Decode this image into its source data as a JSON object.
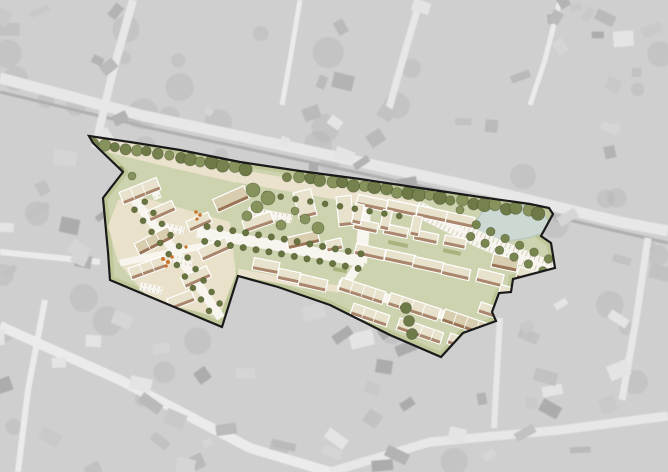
{
  "canvas": {
    "w": 668,
    "h": 472
  },
  "colors": {
    "aerial_base": "#b9b9b9",
    "aerial_road": "#dcdcdc",
    "aerial_road_light": "#e2e2e2",
    "aerial_veg": "#8a8a8a",
    "overlay_white": "#ffffff",
    "site_green": "#cdd3ae",
    "verge": "#b9c392",
    "plaza": "#e9e1ca",
    "street_beige": "#eae2cc",
    "street_white": "#f7f5ee",
    "tick": "#c6bfa9",
    "building": "#e8e2cc",
    "building_dark": "#d9cdaf",
    "band": "#a9866c",
    "band_dark": "#997455",
    "building_outline": "#ffffff",
    "boundary": "#1a1a1a",
    "pond_fill": "#ccd9d3",
    "pond_edge": "#b7c7bf",
    "hedge": "#a9b37e",
    "tree_palette": [
      "#76824d",
      "#87935c",
      "#6d7a47"
    ],
    "street_tree": "#68743f",
    "avenue_tree": "#79854f",
    "column_tree": "#6e7a48",
    "orange": "#c8742e",
    "house_shades": [
      "#8f8f8f",
      "#9a9a9a",
      "#a5a5a5",
      "#b0b0b0",
      "#858585",
      "#c2c2c2",
      "#d8d8d8"
    ]
  },
  "aerial": {
    "seed_houses": 7,
    "seed_veg": 23,
    "house_count": 130,
    "veg_count": 52,
    "overlay_opacity": 0.32,
    "roads": [
      {
        "pts": [
          [
            0,
            78
          ],
          [
            140,
            115
          ],
          [
            300,
            149
          ],
          [
            470,
            186
          ],
          [
            620,
            222
          ],
          [
            668,
            231
          ]
        ],
        "w": 11,
        "c": "aerial_road"
      },
      {
        "pts": [
          [
            0,
            92
          ],
          [
            150,
            128
          ],
          [
            300,
            160
          ],
          [
            470,
            197
          ],
          [
            668,
            243
          ]
        ],
        "w": 3,
        "c": "aerial_veg"
      },
      {
        "pts": [
          [
            133,
            0
          ],
          [
            112,
            75
          ],
          [
            95,
            148
          ]
        ],
        "w": 8,
        "c": "aerial_road"
      },
      {
        "pts": [
          [
            300,
            0
          ],
          [
            290,
            60
          ],
          [
            282,
            105
          ]
        ],
        "w": 5,
        "c": "aerial_road_light"
      },
      {
        "pts": [
          [
            420,
            0
          ],
          [
            402,
            62
          ],
          [
            388,
            112
          ]
        ],
        "w": 7,
        "c": "aerial_road"
      },
      {
        "pts": [
          [
            560,
            0
          ],
          [
            545,
            60
          ],
          [
            530,
            105
          ]
        ],
        "w": 5,
        "c": "aerial_road_light"
      },
      {
        "pts": [
          [
            0,
            326
          ],
          [
            120,
            380
          ],
          [
            250,
            448
          ],
          [
            330,
            472
          ]
        ],
        "w": 10,
        "c": "aerial_road_light"
      },
      {
        "pts": [
          [
            330,
            472
          ],
          [
            430,
            442
          ],
          [
            560,
            430
          ],
          [
            668,
            416
          ]
        ],
        "w": 9,
        "c": "aerial_road"
      },
      {
        "pts": [
          [
            500,
            318
          ],
          [
            497,
            372
          ],
          [
            494,
            428
          ]
        ],
        "w": 6,
        "c": "aerial_road"
      },
      {
        "pts": [
          [
            648,
            238
          ],
          [
            636,
            320
          ],
          [
            622,
            400
          ]
        ],
        "w": 7,
        "c": "aerial_road"
      },
      {
        "pts": [
          [
            45,
            300
          ],
          [
            28,
            390
          ],
          [
            18,
            472
          ]
        ],
        "w": 6,
        "c": "aerial_road_light"
      },
      {
        "pts": [
          [
            0,
            252
          ],
          [
            60,
            258
          ],
          [
            100,
            262
          ]
        ],
        "w": 6,
        "c": "aerial_road_light"
      }
    ]
  },
  "site": {
    "boundary": [
      [
        89,
        136
      ],
      [
        130,
        142
      ],
      [
        180,
        150
      ],
      [
        240,
        162
      ],
      [
        300,
        171
      ],
      [
        360,
        179
      ],
      [
        420,
        188
      ],
      [
        480,
        197
      ],
      [
        530,
        204
      ],
      [
        549,
        208
      ],
      [
        553,
        214
      ],
      [
        541,
        236
      ],
      [
        551,
        243
      ],
      [
        555,
        268
      ],
      [
        513,
        279
      ],
      [
        511,
        292
      ],
      [
        499,
        293
      ],
      [
        492,
        312
      ],
      [
        496,
        321
      ],
      [
        463,
        333
      ],
      [
        441,
        357
      ],
      [
        390,
        335
      ],
      [
        330,
        305
      ],
      [
        278,
        287
      ],
      [
        238,
        276
      ],
      [
        222,
        327
      ],
      [
        110,
        280
      ],
      [
        108,
        252
      ],
      [
        103,
        198
      ],
      [
        123,
        172
      ],
      [
        93,
        143
      ]
    ],
    "top_edge_count": 10,
    "plaza": [
      [
        138,
        196
      ],
      [
        230,
        222
      ],
      [
        236,
        274
      ],
      [
        219,
        317
      ],
      [
        150,
        300
      ],
      [
        118,
        262
      ],
      [
        108,
        226
      ],
      [
        118,
        200
      ]
    ],
    "pond": [
      [
        476,
        222
      ],
      [
        482,
        212
      ],
      [
        496,
        206
      ],
      [
        514,
        204
      ],
      [
        532,
        207
      ],
      [
        545,
        214
      ],
      [
        549,
        224
      ],
      [
        543,
        233
      ],
      [
        528,
        238
      ],
      [
        508,
        241
      ],
      [
        490,
        238
      ],
      [
        479,
        232
      ]
    ],
    "streets": [
      {
        "pts": [
          [
            92,
            141
          ],
          [
            160,
            158
          ],
          [
            238,
            176
          ]
        ],
        "w": 14,
        "c": "street_beige",
        "ticks": false
      },
      {
        "pts": [
          [
            238,
            176
          ],
          [
            330,
            192
          ],
          [
            418,
            208
          ]
        ],
        "w": 13,
        "c": "street_beige",
        "ticks": false
      },
      {
        "pts": [
          [
            238,
            272
          ],
          [
            300,
            284
          ],
          [
            340,
            289
          ]
        ],
        "w": 7,
        "c": "street_beige",
        "ticks": false
      },
      {
        "pts": [
          [
            416,
            208
          ],
          [
            480,
            240
          ],
          [
            553,
            270
          ]
        ],
        "w": 16,
        "c": "street_white",
        "ticks": true
      },
      {
        "pts": [
          [
            366,
            197
          ],
          [
            361,
            263
          ]
        ],
        "w": 12,
        "c": "street_white",
        "ticks": false
      },
      {
        "pts": [
          [
            361,
            262
          ],
          [
            344,
            286
          ]
        ],
        "w": 9,
        "c": "street_white",
        "ticks": false
      },
      {
        "pts": [
          [
            197,
            232
          ],
          [
            280,
            246
          ],
          [
            364,
            262
          ]
        ],
        "w": 11,
        "c": "street_white",
        "ticks": false
      },
      {
        "pts": [
          [
            338,
            284
          ],
          [
            420,
            308
          ],
          [
            491,
            329
          ]
        ],
        "w": 10,
        "c": "street_white",
        "ticks": false
      },
      {
        "pts": [
          [
            133,
            198
          ],
          [
            180,
            258
          ],
          [
            221,
            318
          ]
        ],
        "w": 9,
        "c": "street_white",
        "ticks": false
      },
      {
        "pts": [
          [
            120,
            263
          ],
          [
            232,
            240
          ]
        ],
        "w": 7,
        "c": "street_white",
        "ticks": false
      }
    ],
    "parking_strips": [
      {
        "pts": [
          [
            248,
            211
          ],
          [
            292,
            219
          ]
        ],
        "w": 9
      },
      {
        "pts": [
          [
            162,
            226
          ],
          [
            184,
            231
          ]
        ],
        "w": 8
      },
      {
        "pts": [
          [
            170,
            258
          ],
          [
            192,
            263
          ]
        ],
        "w": 8
      },
      {
        "pts": [
          [
            140,
            286
          ],
          [
            162,
            291
          ]
        ],
        "w": 8
      },
      {
        "pts": [
          [
            151,
            181
          ],
          [
            158,
            199
          ]
        ],
        "w": 8
      }
    ],
    "hedges": [
      [
        398,
        244,
        20,
        4,
        12
      ],
      [
        452,
        252,
        18,
        4,
        12
      ],
      [
        516,
        300,
        16,
        4,
        16
      ],
      [
        340,
        270,
        14,
        4,
        12
      ]
    ],
    "buildings": [
      [
        140,
        191,
        40,
        13,
        -22,
        0
      ],
      [
        161,
        211,
        28,
        11,
        -24,
        0
      ],
      [
        154,
        241,
        38,
        13,
        -27,
        1
      ],
      [
        147,
        268,
        36,
        12,
        -20,
        0
      ],
      [
        196,
        277,
        28,
        12,
        -24,
        0
      ],
      [
        214,
        249,
        30,
        13,
        -24,
        0
      ],
      [
        199,
        222,
        24,
        11,
        -24,
        0
      ],
      [
        181,
        300,
        26,
        12,
        -21,
        0
      ],
      [
        231,
        199,
        34,
        14,
        -24,
        1
      ],
      [
        258,
        222,
        30,
        12,
        -19,
        0
      ],
      [
        305,
        204,
        18,
        27,
        -14,
        0
      ],
      [
        345,
        211,
        15,
        30,
        -6,
        0
      ],
      [
        303,
        240,
        32,
        12,
        -13,
        1
      ],
      [
        334,
        245,
        16,
        11,
        -12,
        0
      ],
      [
        266,
        266,
        26,
        12,
        11,
        0
      ],
      [
        289,
        276,
        22,
        11,
        12,
        0
      ],
      [
        313,
        283,
        28,
        12,
        13,
        0
      ],
      [
        372,
        203,
        30,
        11,
        12,
        0
      ],
      [
        366,
        226,
        24,
        10,
        12,
        0
      ],
      [
        358,
        214,
        9,
        20,
        12,
        0
      ],
      [
        402,
        208,
        30,
        11,
        12,
        0
      ],
      [
        396,
        231,
        24,
        10,
        12,
        0
      ],
      [
        386,
        220,
        9,
        20,
        12,
        0
      ],
      [
        432,
        214,
        30,
        11,
        12,
        0
      ],
      [
        426,
        237,
        24,
        10,
        12,
        0
      ],
      [
        416,
        226,
        9,
        20,
        12,
        0
      ],
      [
        460,
        220,
        28,
        11,
        12,
        0
      ],
      [
        455,
        242,
        22,
        10,
        12,
        0
      ],
      [
        370,
        252,
        30,
        11,
        12,
        0
      ],
      [
        400,
        258,
        30,
        11,
        12,
        0
      ],
      [
        428,
        265,
        30,
        11,
        12,
        0
      ],
      [
        456,
        272,
        28,
        11,
        13,
        0
      ],
      [
        490,
        278,
        26,
        13,
        14,
        0
      ],
      [
        505,
        263,
        26,
        13,
        12,
        1
      ],
      [
        528,
        276,
        22,
        12,
        20,
        0
      ],
      [
        509,
        293,
        20,
        12,
        16,
        0
      ],
      [
        362,
        291,
        46,
        13,
        18,
        0
      ],
      [
        414,
        307,
        52,
        13,
        18,
        0
      ],
      [
        466,
        323,
        48,
        13,
        19,
        1
      ],
      [
        370,
        315,
        38,
        12,
        19,
        0
      ],
      [
        420,
        331,
        46,
        12,
        19,
        0
      ],
      [
        462,
        343,
        28,
        11,
        20,
        0
      ],
      [
        488,
        310,
        18,
        11,
        18,
        0
      ]
    ],
    "trees": {
      "top_row": {
        "spacing": 11,
        "y_offset": 7,
        "gap": [
          246,
          286
        ],
        "r_min": 4.5,
        "r_max": 7,
        "seed": 11
      },
      "rows": [
        {
          "pts": [
            [
              200,
              233
            ],
            [
              280,
              246
            ],
            [
              364,
              262
            ]
          ],
          "offset": 7.5,
          "spacing": 13,
          "sides": [
            -1,
            1
          ],
          "r": 3.2,
          "c": "street_tree"
        },
        {
          "pts": [
            [
              136,
              201
            ],
            [
              180,
              258
            ],
            [
              219,
              314
            ]
          ],
          "offset": 6.5,
          "spacing": 14,
          "sides": [
            -1,
            1
          ],
          "r": 3.0,
          "c": "street_tree"
        },
        {
          "pts": [
            [
              246,
              186
            ],
            [
              412,
              213
            ]
          ],
          "offset": 5,
          "spacing": 15,
          "sides": [
            1
          ],
          "r": 3.0,
          "c": "street_tree"
        },
        {
          "pts": [
            [
              468,
              228
            ],
            [
              548,
              266
            ]
          ],
          "offset": 6.5,
          "spacing": 16,
          "sides": [
            -1,
            1
          ],
          "r": 4.3,
          "c": "avenue_tree"
        }
      ],
      "canopy": [
        [
          253,
          190,
          7
        ],
        [
          268,
          198,
          7
        ],
        [
          257,
          207,
          6
        ],
        [
          247,
          216,
          5
        ],
        [
          281,
          225,
          5
        ],
        [
          305,
          219,
          5
        ],
        [
          318,
          228,
          6
        ],
        [
          295,
          211,
          4
        ],
        [
          132,
          176,
          4
        ],
        [
          120,
          170,
          3.5
        ],
        [
          460,
          210,
          4
        ]
      ],
      "column": [
        [
          406,
          308,
          5.5
        ],
        [
          409,
          321,
          5.5
        ],
        [
          412,
          334,
          5.5
        ]
      ]
    },
    "orange_dots": [
      [
        163,
        259,
        2
      ],
      [
        168,
        262,
        2
      ],
      [
        172,
        257,
        1.8
      ],
      [
        166,
        266,
        1.8
      ],
      [
        196,
        212,
        1.8
      ],
      [
        200,
        215,
        1.8
      ],
      [
        197,
        219,
        1.6
      ],
      [
        186,
        247,
        1.6
      ]
    ]
  }
}
